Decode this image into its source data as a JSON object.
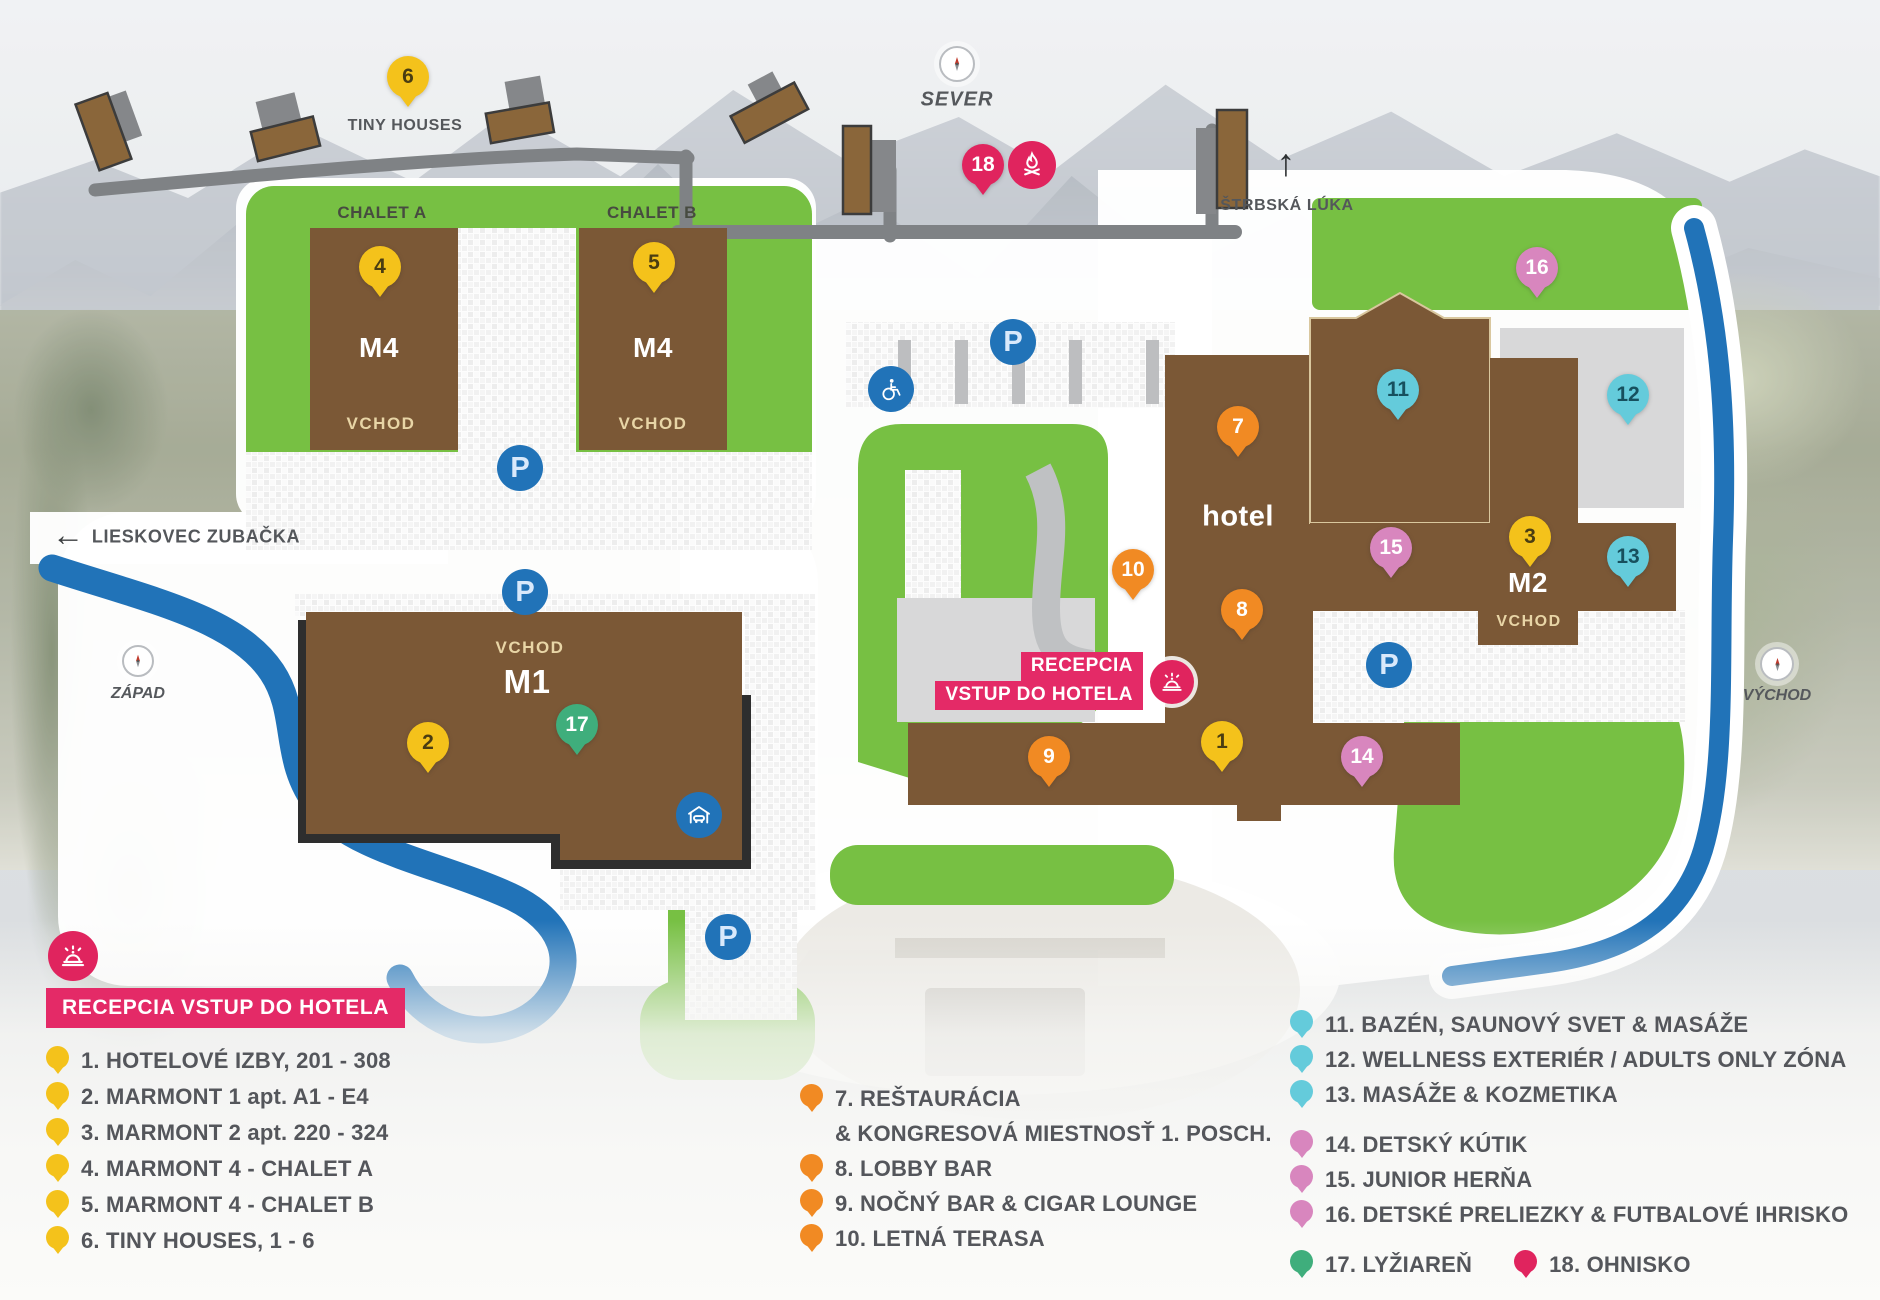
{
  "map": {
    "compass": {
      "north": "SEVER",
      "west": "ZÁPAD",
      "east": "VÝCHOD"
    },
    "directions": {
      "strbska_luka": "ŠTRBSKÁ LÚKA",
      "lieskovec_zubacka": "LIESKOVEC ZUBAČKA"
    },
    "areas": {
      "tiny_houses": "TINY HOUSES",
      "chalet_a": "CHALET A",
      "chalet_b": "CHALET B"
    },
    "buildings": {
      "m4": "M4",
      "m1": "M1",
      "m2": "M2",
      "hotel": "hotel",
      "vchod": "VCHOD"
    },
    "reception_badge": {
      "line1": "RECEPCIA",
      "line2": "VSTUP DO HOTELA"
    },
    "parking_letter": "P",
    "icons": {
      "up_arrow": "↑",
      "left_arrow": "←"
    },
    "markers": [
      {
        "num": "1",
        "color": "yellow",
        "x": 1222,
        "y": 772
      },
      {
        "num": "2",
        "color": "yellow",
        "x": 428,
        "y": 773
      },
      {
        "num": "3",
        "color": "yellow",
        "x": 1530,
        "y": 567
      },
      {
        "num": "4",
        "color": "yellow",
        "x": 380,
        "y": 297
      },
      {
        "num": "5",
        "color": "yellow",
        "x": 654,
        "y": 293
      },
      {
        "num": "6",
        "color": "yellow",
        "x": 408,
        "y": 107
      },
      {
        "num": "7",
        "color": "orange",
        "x": 1238,
        "y": 457
      },
      {
        "num": "8",
        "color": "orange",
        "x": 1242,
        "y": 640
      },
      {
        "num": "9",
        "color": "orange",
        "x": 1049,
        "y": 787
      },
      {
        "num": "10",
        "color": "orange",
        "x": 1133,
        "y": 600
      },
      {
        "num": "11",
        "color": "teal",
        "x": 1398,
        "y": 420
      },
      {
        "num": "12",
        "color": "teal",
        "x": 1628,
        "y": 425
      },
      {
        "num": "13",
        "color": "teal",
        "x": 1628,
        "y": 587
      },
      {
        "num": "14",
        "color": "pink",
        "x": 1362,
        "y": 787
      },
      {
        "num": "15",
        "color": "pink",
        "x": 1391,
        "y": 578
      },
      {
        "num": "16",
        "color": "pink",
        "x": 1537,
        "y": 298
      },
      {
        "num": "17",
        "color": "green",
        "x": 577,
        "y": 755
      },
      {
        "num": "18",
        "color": "crimson",
        "x": 983,
        "y": 195
      }
    ],
    "parkings": [
      {
        "x": 520,
        "y": 468
      },
      {
        "x": 525,
        "y": 592
      },
      {
        "x": 1013,
        "y": 342
      },
      {
        "x": 728,
        "y": 937
      },
      {
        "x": 1389,
        "y": 665
      }
    ]
  },
  "legend": {
    "reception_label": "RECEPCIA VSTUP DO HOTELA",
    "columns": [
      {
        "items": [
          {
            "label": "1. HOTELOVÉ IZBY, 201 - 308",
            "color": "yellow"
          },
          {
            "label": "2. MARMONT 1 apt. A1 - E4",
            "color": "yellow"
          },
          {
            "label": "3. MARMONT 2 apt. 220 - 324",
            "color": "yellow"
          },
          {
            "label": "4. MARMONT 4 - CHALET A",
            "color": "yellow"
          },
          {
            "label": "5. MARMONT 4 - CHALET B",
            "color": "yellow"
          },
          {
            "label": "6. TINY HOUSES, 1 - 6",
            "color": "yellow"
          }
        ]
      },
      {
        "items": [
          {
            "label": "7. REŠTAURÁCIA",
            "color": "orange"
          },
          {
            "label": "& KONGRESOVÁ MIESTNOSŤ 1. POSCH.",
            "indent": true
          },
          {
            "label": "8. LOBBY BAR",
            "color": "orange"
          },
          {
            "label": "9. NOČNÝ BAR & CIGAR LOUNGE",
            "color": "orange"
          },
          {
            "label": "10. LETNÁ TERASA",
            "color": "orange"
          }
        ]
      },
      {
        "items": [
          {
            "label": "11. BAZÉN, SAUNOVÝ SVET & MASÁŽE",
            "color": "teal"
          },
          {
            "label": "12. WELLNESS EXTERIÉR / ADULTS ONLY ZÓNA",
            "color": "teal"
          },
          {
            "label": "13. MASÁŽE & KOZMETIKA",
            "color": "teal"
          },
          {
            "label": "14. DETSKÝ KÚTIK",
            "color": "pink",
            "gap": true
          },
          {
            "label": "15. JUNIOR HERŇA",
            "color": "pink"
          },
          {
            "label": "16. DETSKÉ PRELIEZKY & FUTBALOVÉ IHRISKO",
            "color": "pink"
          },
          {
            "pair": [
              {
                "label": "17. LYŽIAREŇ",
                "color": "green"
              },
              {
                "label": "18. OHNISKO",
                "color": "crimson"
              }
            ],
            "gap": true
          }
        ]
      }
    ]
  },
  "colors": {
    "accent_blue": "#2173B8",
    "crimson": "#E42A67",
    "lawn_green": "#77C043",
    "building_brown": "#7B5836",
    "road_gray": "#7F8285",
    "marker_yellow": "#F4C21B",
    "marker_orange": "#F18A23",
    "marker_teal": "#64CBDB",
    "marker_pink": "#D886BE",
    "marker_green": "#3FAE7C",
    "marker_crimson": "#E0245E"
  }
}
